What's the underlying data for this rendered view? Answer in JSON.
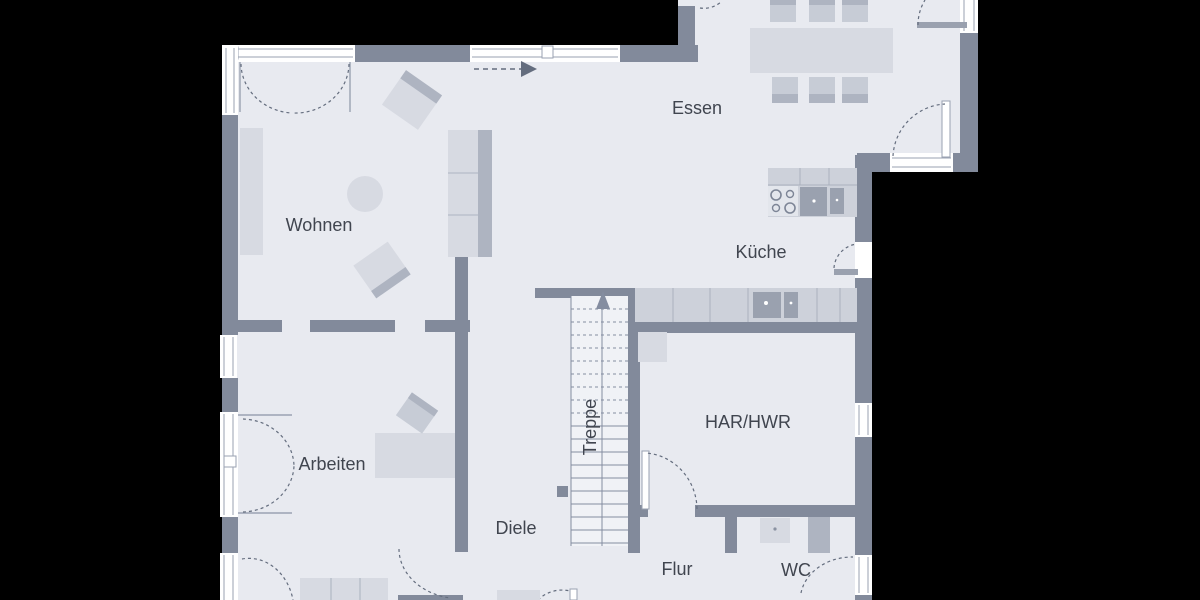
{
  "labels": {
    "essen": "Essen",
    "wohnen": "Wohnen",
    "kueche": "Küche",
    "arbeiten": "Arbeiten",
    "treppe": "Treppe",
    "har_hwr": "HAR/HWR",
    "diele": "Diele",
    "flur": "Flur",
    "wc": "WC"
  },
  "colors": {
    "background": "#000000",
    "floor": "#e8eaf0",
    "stair_bg": "#f0f2f6",
    "wall": "#828a9b",
    "window": "#ffffff",
    "line": "#9aa2b2",
    "arc": "#646d7e",
    "stair_line": "#848da0",
    "counter": "#cdd1da",
    "counter_line": "#aab1bd",
    "furniture_light": "#d7dae2",
    "furniture_medium": "#c7ccd6",
    "furniture_back": "#aeb4c1",
    "appliance": "#9aa1af",
    "label_text": "#40454f"
  }
}
